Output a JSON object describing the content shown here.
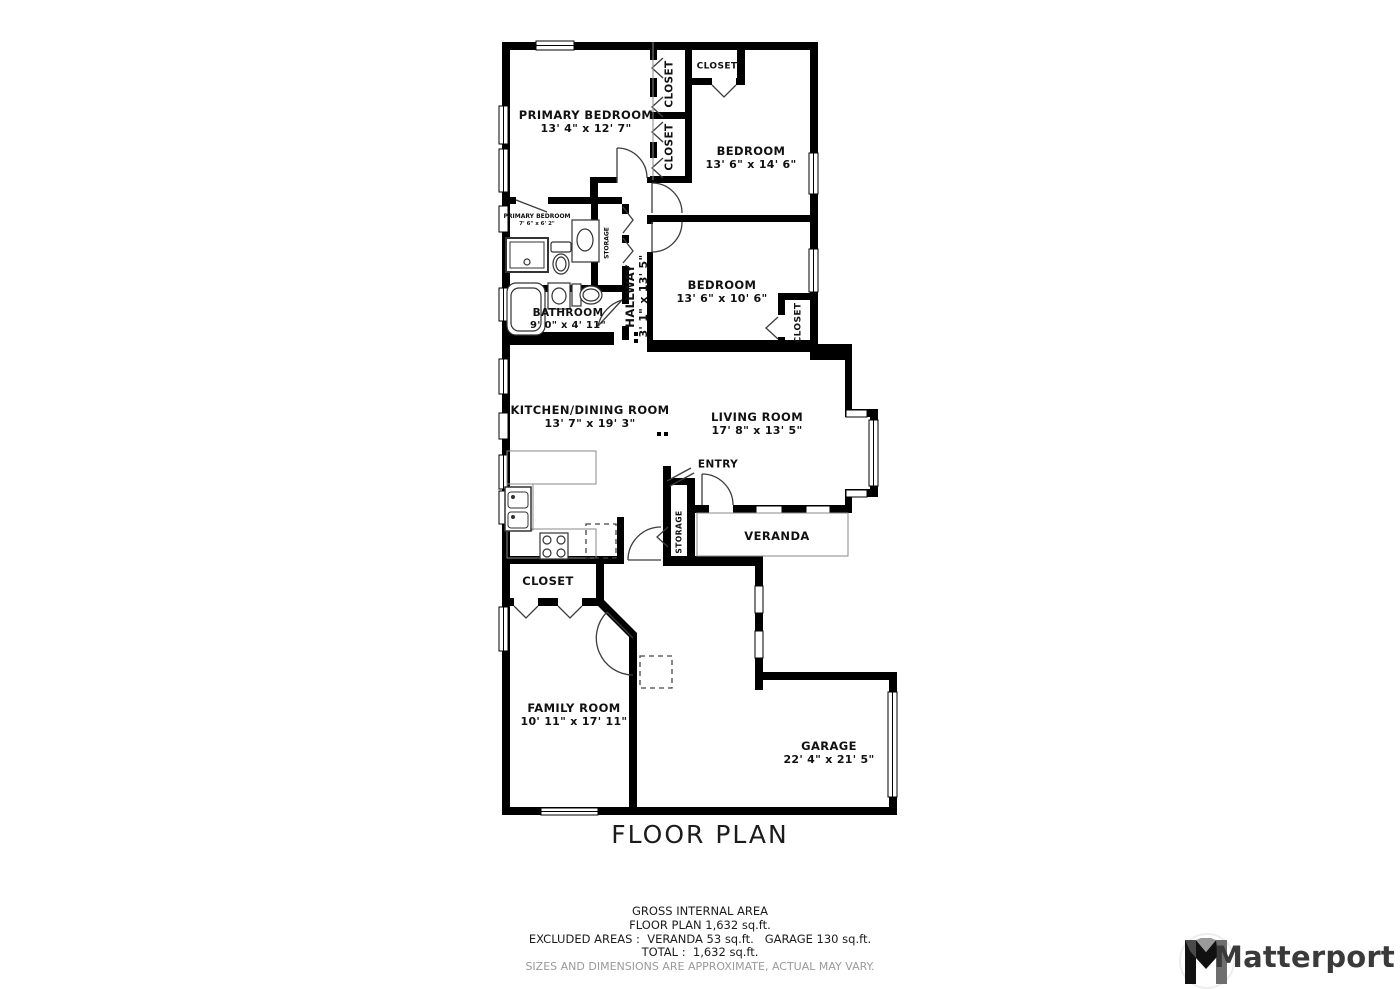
{
  "title": "FLOOR PLAN",
  "footer": {
    "line1": "GROSS INTERNAL AREA",
    "line2": "FLOOR PLAN 1,632 sq.ft.",
    "line3": "EXCLUDED AREAS :  VERANDA 53 sq.ft.   GARAGE 130 sq.ft.",
    "line4": "TOTAL :  1,632 sq.ft.",
    "disclaimer": "SIZES AND DIMENSIONS ARE APPROXIMATE, ACTUAL MAY VARY."
  },
  "brand": {
    "name": "Matterport"
  },
  "rooms": {
    "primary_bedroom": {
      "name": "PRIMARY BEDROOM",
      "dims": "13' 4\" x 12' 7\""
    },
    "bedroom_top": {
      "name": "BEDROOM",
      "dims": "13' 6\" x 14' 6\""
    },
    "bedroom_mid": {
      "name": "BEDROOM",
      "dims": "13' 6\" x 10' 6\""
    },
    "primary_bathroom": {
      "name": "PRIMARY BEDROOM",
      "dims": "7' 6\" x 6' 2\""
    },
    "bathroom": {
      "name": "BATHROOM",
      "dims": "9' 0\" x 4' 11\""
    },
    "hallway": {
      "name": "HALLWAY",
      "dims": "3' 1\" x 13' 5\""
    },
    "kitchen_dining": {
      "name": "KITCHEN/DINING ROOM",
      "dims": "13' 7\" x 19' 3\""
    },
    "living_room": {
      "name": "LIVING ROOM",
      "dims": "17' 8\" x 13' 5\""
    },
    "entry": {
      "name": "ENTRY"
    },
    "veranda": {
      "name": "VERANDA"
    },
    "family_room": {
      "name": "FAMILY ROOM",
      "dims": "10' 11\" x 17' 11\""
    },
    "garage": {
      "name": "GARAGE",
      "dims": "22' 4\" x 21' 5\""
    },
    "closet_family": {
      "name": "CLOSET"
    },
    "closet_primary_1": {
      "name": "CLOSET"
    },
    "closet_primary_2": {
      "name": "CLOSET"
    },
    "closet_bedroom_top": {
      "name": "CLOSET"
    },
    "closet_bedroom_mid": {
      "name": "CLOSET"
    },
    "storage_hallway": {
      "name": "STORAGE"
    },
    "storage_entry": {
      "name": "STORAGE"
    }
  },
  "colors": {
    "wall": "#000000",
    "background": "#ffffff",
    "label_text": "#111111",
    "disclaimer_text": "#9a9a9a",
    "brand_text": "#3a3a3a"
  }
}
